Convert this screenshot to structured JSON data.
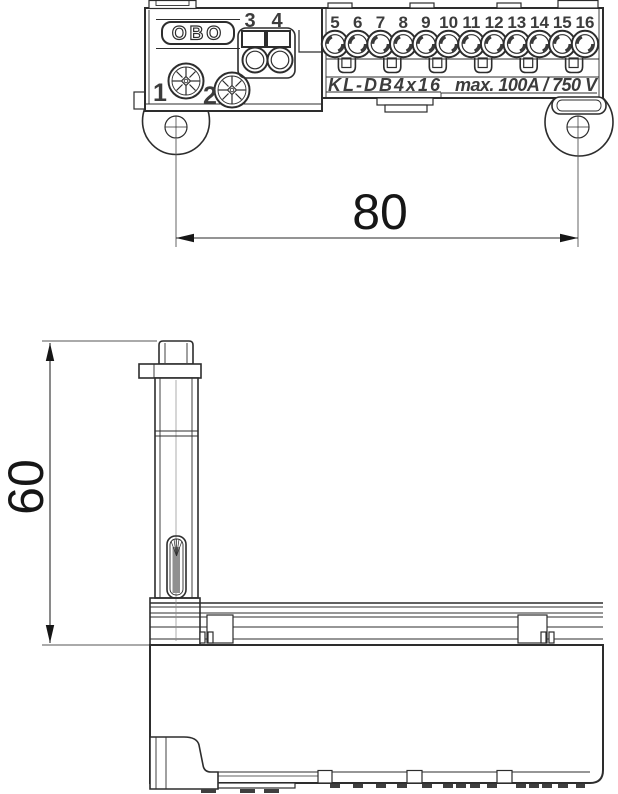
{
  "colors": {
    "line": "#2d2d2d",
    "label": "#3c3c3c",
    "dim": "#555555",
    "text": "#161616"
  },
  "top_view": {
    "logo": "OBO",
    "screw_labels": [
      "1",
      "2"
    ],
    "pair_labels": [
      "3",
      "4"
    ],
    "terminal_labels": [
      "5",
      "6",
      "7",
      "8",
      "9",
      "10",
      "11",
      "12",
      "13",
      "14",
      "15",
      "16"
    ],
    "model_label": "KL-DB4x16",
    "rating_label": "max. 100A / 750 V"
  },
  "dimensions": {
    "width_mm": "80",
    "height_mm": "60"
  }
}
